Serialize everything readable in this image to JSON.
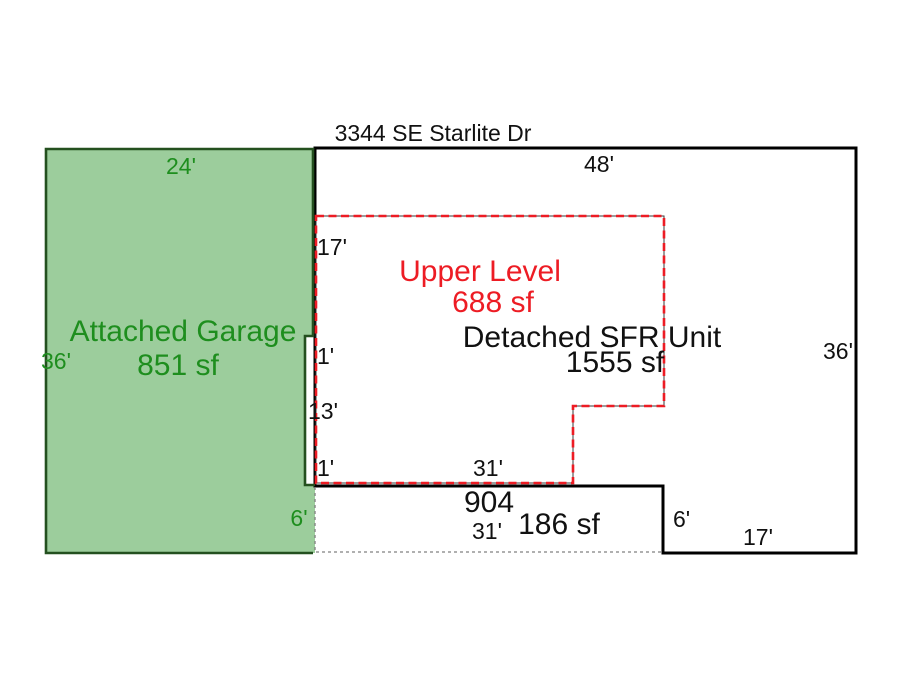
{
  "title": {
    "street": "3344 SE Starlite Dr"
  },
  "garage": {
    "name": "Attached Garage",
    "area": "851 sf",
    "dim_top": "24'",
    "dim_left": "36'",
    "dim_bottom": "24'",
    "dim_step_right": "6'"
  },
  "sfr": {
    "name": "Detached SFR Unit",
    "area": "1555 sf",
    "dim_top": "48'",
    "dim_right": "36'",
    "dim_step": "6'",
    "dim_bottom_right": "17'"
  },
  "upper": {
    "name": "Upper Level",
    "area": "688 sf",
    "dim_left_top": "17'",
    "dim_jog_top": "1'",
    "dim_left_mid": "13'",
    "dim_jog_bottom": "1'",
    "dim_bottom": "31'"
  },
  "porch": {
    "number": "904",
    "area": "186 sf",
    "dim_bottom": "31'"
  },
  "colors": {
    "ink": "#111111",
    "line": "#000000",
    "red": "#ed1c24",
    "red_underlay": "#3a3a3a",
    "green_fill": "#9ccd9c",
    "green_border": "#24501f",
    "green_text": "#1e8e1e",
    "gray_dash": "#808080",
    "bg": "#ffffff"
  }
}
